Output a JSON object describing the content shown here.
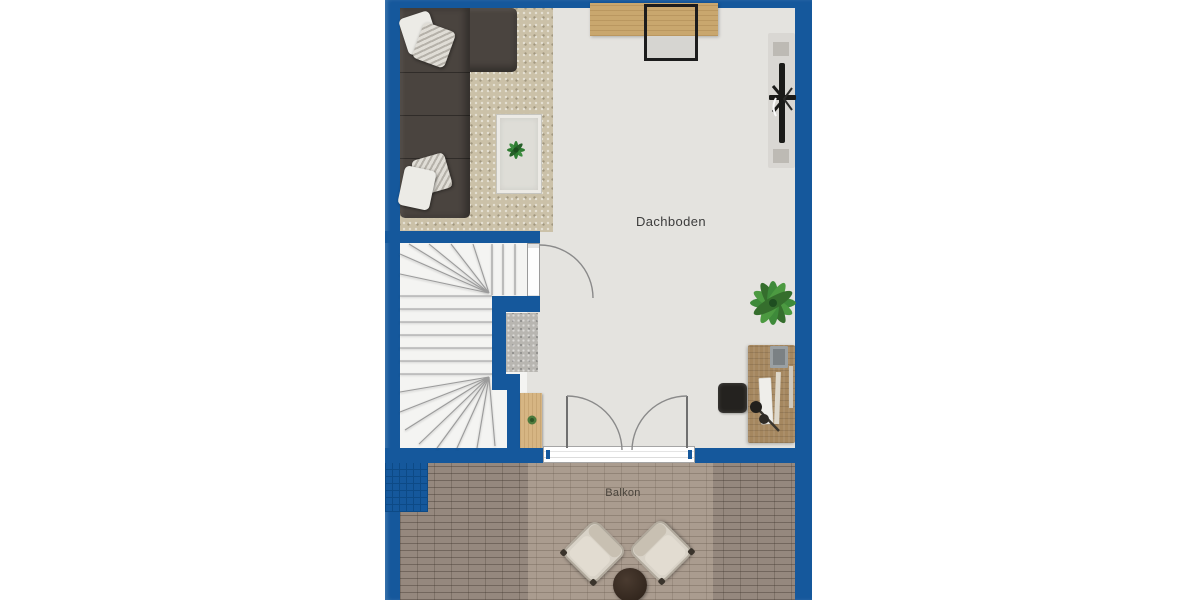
{
  "title": "Floor plan – attic level",
  "rooms": {
    "attic": {
      "label": "Dachboden"
    },
    "balcony": {
      "label": "Balkon"
    }
  },
  "furniture": [
    "corner-sofa",
    "throw-pillows",
    "white-rug-with-plant",
    "wall-desk",
    "desk-chair",
    "weight-bench-on-mat",
    "potted-palm",
    "office-desk",
    "office-swivel-chair",
    "winder-staircase",
    "stair-door",
    "hall-mat",
    "wood-sideboard-with-plant",
    "double-french-doors",
    "balcony-armchair-left",
    "balcony-armchair-right",
    "balcony-round-table"
  ],
  "colors": {
    "wall": "#15589c",
    "wallGrid": "#0d4a86",
    "floor": "#e4e3df",
    "carpet": "#cbc1a8",
    "stairFloor": "#f4f4f2",
    "stepLine": "#9b9b9b",
    "sofa": "#4a443f",
    "pillowWhite": "#ecebe6",
    "pillowPattern": "#b5b1a9",
    "rugWhite": "#deddd7",
    "matGray": "#b8b6b1",
    "woodLight": "#c9a76e",
    "woodMid": "#a5875f",
    "woodSide": "#d6b583",
    "deck": "#95887e",
    "chairCream": "#d8d2c7",
    "tableBrown": "#32261d",
    "plantGreen": "#3e8a3a",
    "labelColor": "#3c3c3c"
  }
}
